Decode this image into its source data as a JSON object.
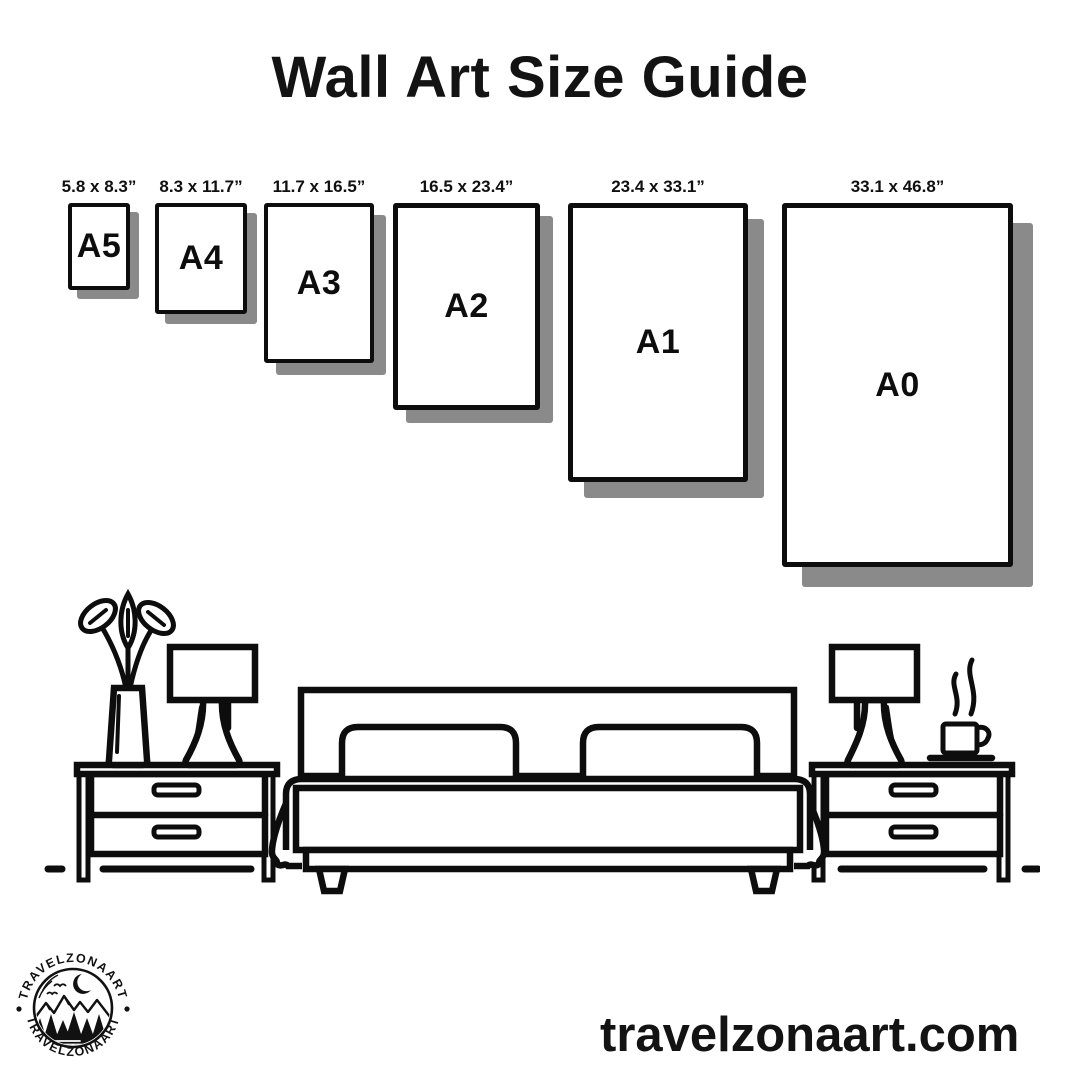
{
  "title": "Wall Art Size Guide",
  "size_guide": {
    "frames": [
      {
        "code": "A5",
        "size": "5.8 x 8.3”"
      },
      {
        "code": "A4",
        "size": "8.3 x 11.7”"
      },
      {
        "code": "A3",
        "size": "11.7 x 16.5”"
      },
      {
        "code": "A2",
        "size": "16.5 x 23.4”"
      },
      {
        "code": "A1",
        "size": "23.4 x 33.1”"
      },
      {
        "code": "A0",
        "size": "33.1 x 46.8”"
      }
    ]
  },
  "footer": {
    "website": "travelzonaart.com",
    "logo_text": "TRAVELZONAART"
  },
  "illustration": {
    "description": "black line-art bedroom scene",
    "items": [
      "flower-vase",
      "table-lamp",
      "nightstand",
      "double-bed",
      "pillows",
      "coffee-cup",
      "floor-line"
    ]
  },
  "colors": {
    "ink": "#0d0d0d",
    "shadow": "#8a8a8a",
    "background": "#ffffff"
  }
}
